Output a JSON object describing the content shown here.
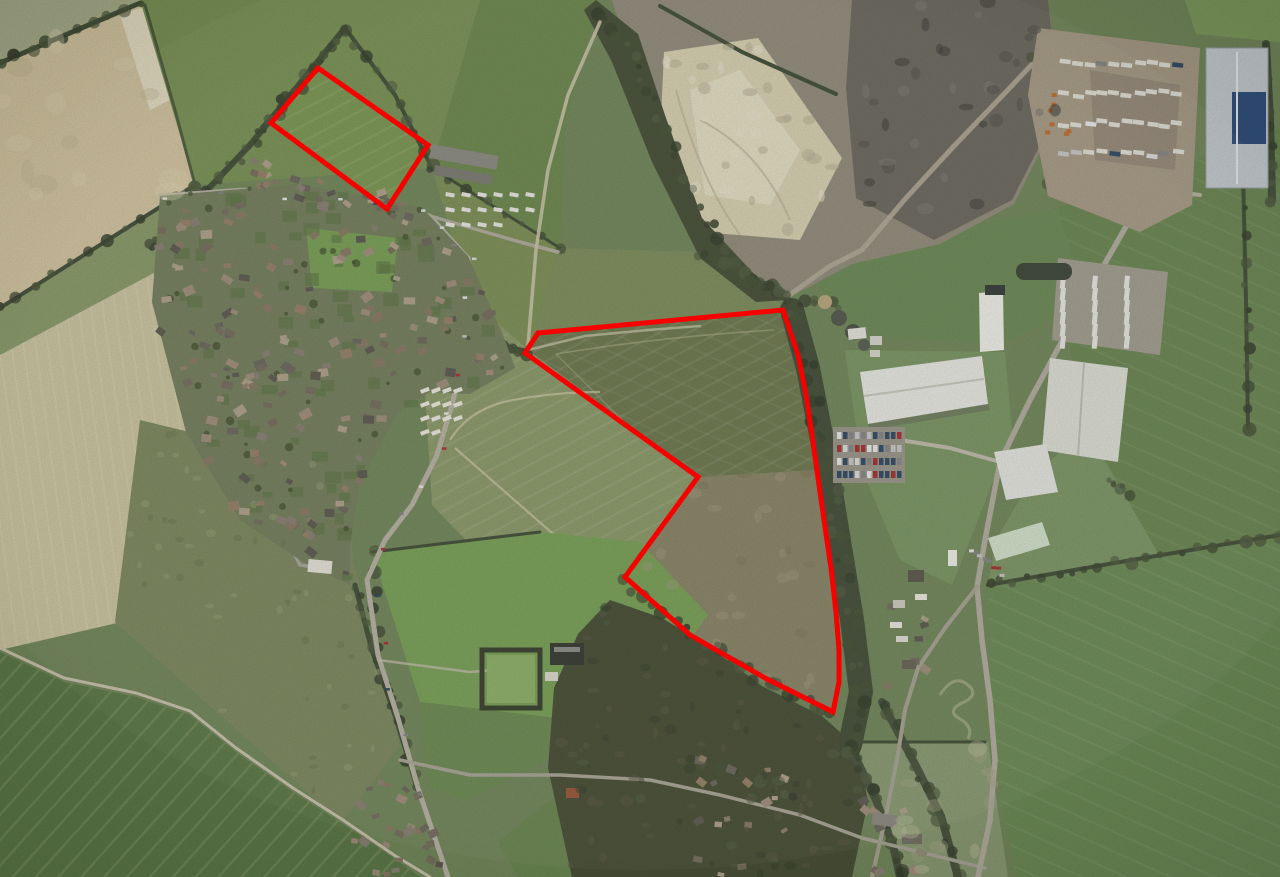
{
  "map": {
    "kind": "aerial-satellite-photograph",
    "scene": "Aerial photograph of a village beside a quarry and industrial estate with surrounding farmland; two land parcels are outlined in red",
    "annotations": {
      "site_outline_color": "#f60000",
      "site_outline_width": 5,
      "parcels": [
        {
          "id": "parcel-north",
          "shape": "quadrilateral",
          "points": "318,68 428,145 387,209 271,123"
        },
        {
          "id": "parcel-main",
          "shape": "irregular-polygon",
          "points": "525,353 538,333 783,310 798,355 806,395 812,435 818,478 824,520 831,568 836,612 839,650 839,682 833,712 765,678 690,635 625,577 698,477"
        }
      ]
    },
    "features": [
      {
        "id": "village",
        "label": "village housing"
      },
      {
        "id": "quarry",
        "label": "quarry workings"
      },
      {
        "id": "lorry-depot",
        "label": "vehicle and trailer depot"
      },
      {
        "id": "industrial-estate",
        "label": "industrial estate warehouses"
      },
      {
        "id": "water-treatment",
        "label": "circular treatment tanks"
      },
      {
        "id": "sports-field",
        "label": "playing fields"
      },
      {
        "id": "bowling-green",
        "label": "bowling green"
      },
      {
        "id": "woodland",
        "label": "woodland and tree corridors"
      },
      {
        "id": "farmland",
        "label": "arable fields with tramlines"
      }
    ],
    "palette": {
      "field_green": "#74895c",
      "pale_arable": "#d2c5a0",
      "woodland": "#49523a",
      "quarry_pale": "#d8d1b2",
      "quarry_dark": "#6e6b61",
      "roof_white": "#e9e9e3",
      "road_grey": "#b5b1a2",
      "outline_red": "#f60000"
    }
  }
}
